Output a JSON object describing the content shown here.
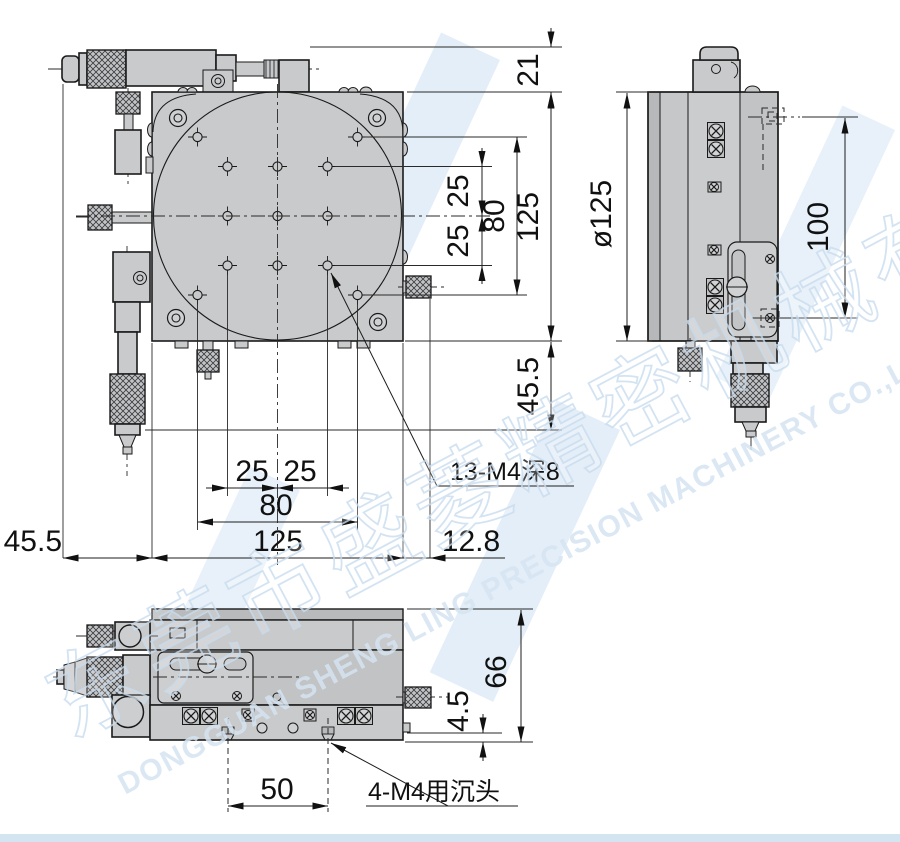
{
  "drawing": {
    "type": "engineering-drawing",
    "part": "XY precision stage with micrometer heads",
    "views": [
      "plan-view",
      "side-view",
      "bottom-view"
    ],
    "colors": {
      "background": "#ffffff",
      "body_fill": "#c9cacc",
      "dark_fill": "#b9babc",
      "line": "#1a1a1a",
      "watermark": "#dce9f5"
    }
  },
  "dims": {
    "top_offset": "21",
    "plate_height": "125",
    "hole_span_v": "80",
    "hole_pitch_v1": "25",
    "hole_pitch_v2": "25",
    "mic_protrusion_v": "45.5",
    "hole_pitch_h1": "25",
    "hole_pitch_h2": "25",
    "hole_span_h": "80",
    "plate_width": "125",
    "mic_protrusion_h": "45.5",
    "knob_protrusion": "12.8",
    "disc_diameter": "ø125",
    "side_height": "100",
    "base_hole_pitch": "50",
    "base_height": "66",
    "countersink_offset": "4.5"
  },
  "labels": {
    "thread_holes": "13-M4深8",
    "countersunk_holes": "4-M4用沉头"
  },
  "watermark": {
    "company_cn": "东莞市盛菱精密机械有限公司",
    "company_en": "DONGGUAN SHENG LING PRECISION MACHINERY CO.,LTD."
  }
}
